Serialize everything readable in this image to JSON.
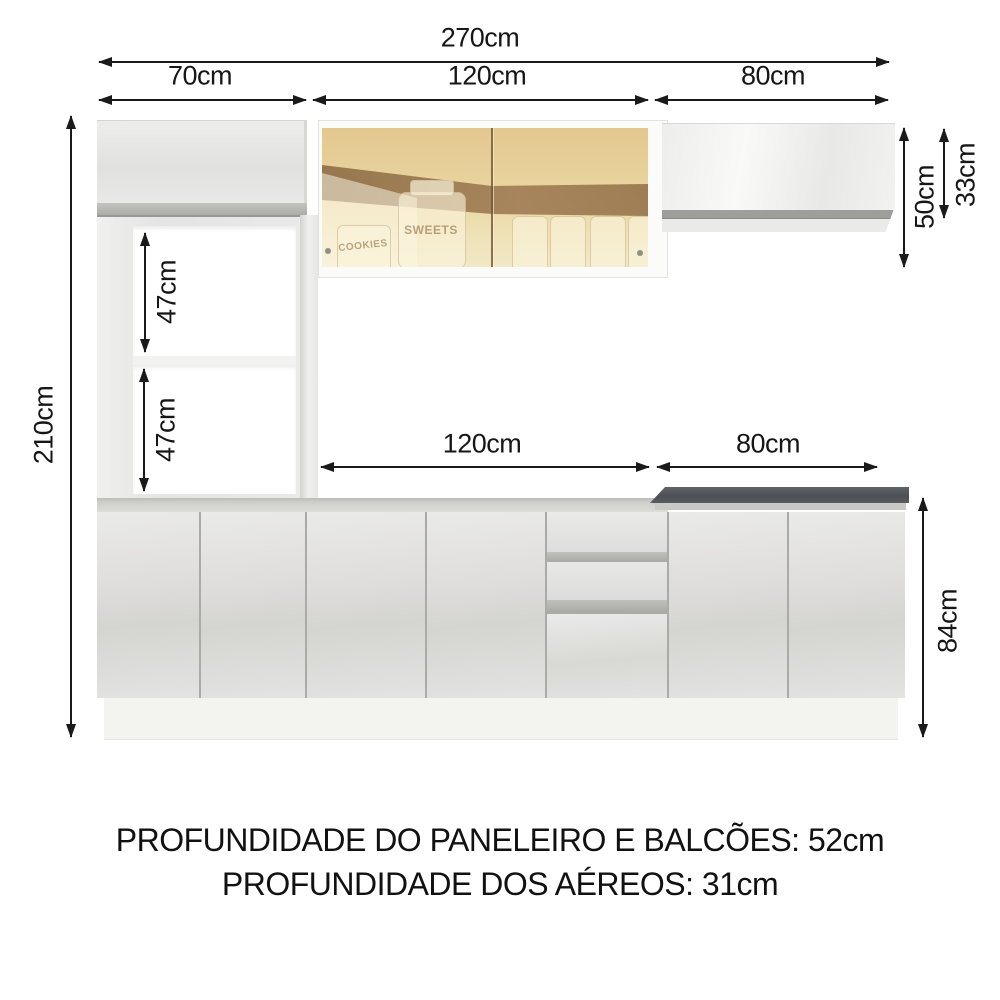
{
  "dims": {
    "total_width": "270cm",
    "pantry_width": "70cm",
    "hood_width_top": "120cm",
    "aerial_width_top": "80cm",
    "total_height": "210cm",
    "niche_upper_height": "47cm",
    "niche_lower_height": "47cm",
    "hood_cabinet_height": "50cm",
    "aerial_cabinet_height": "33cm",
    "counter_mid_width": "120cm",
    "counter_right_width": "80cm",
    "base_height": "84cm"
  },
  "footer": {
    "line1": "PROFUNDIDADE DO PANELEIRO E BALCÕES: 52cm",
    "line2": "PROFUNDIDADE DOS AÉREOS: 31cm"
  },
  "glass": {
    "jar_left": "COOKIES",
    "jar_center": "SWEETS"
  },
  "colors": {
    "arrow": "#1a1a1a",
    "countertop_dark": "#53575b",
    "glass_gold": "#e9d29a",
    "cabinet_white": "#e9e9e7",
    "background": "#ffffff"
  }
}
